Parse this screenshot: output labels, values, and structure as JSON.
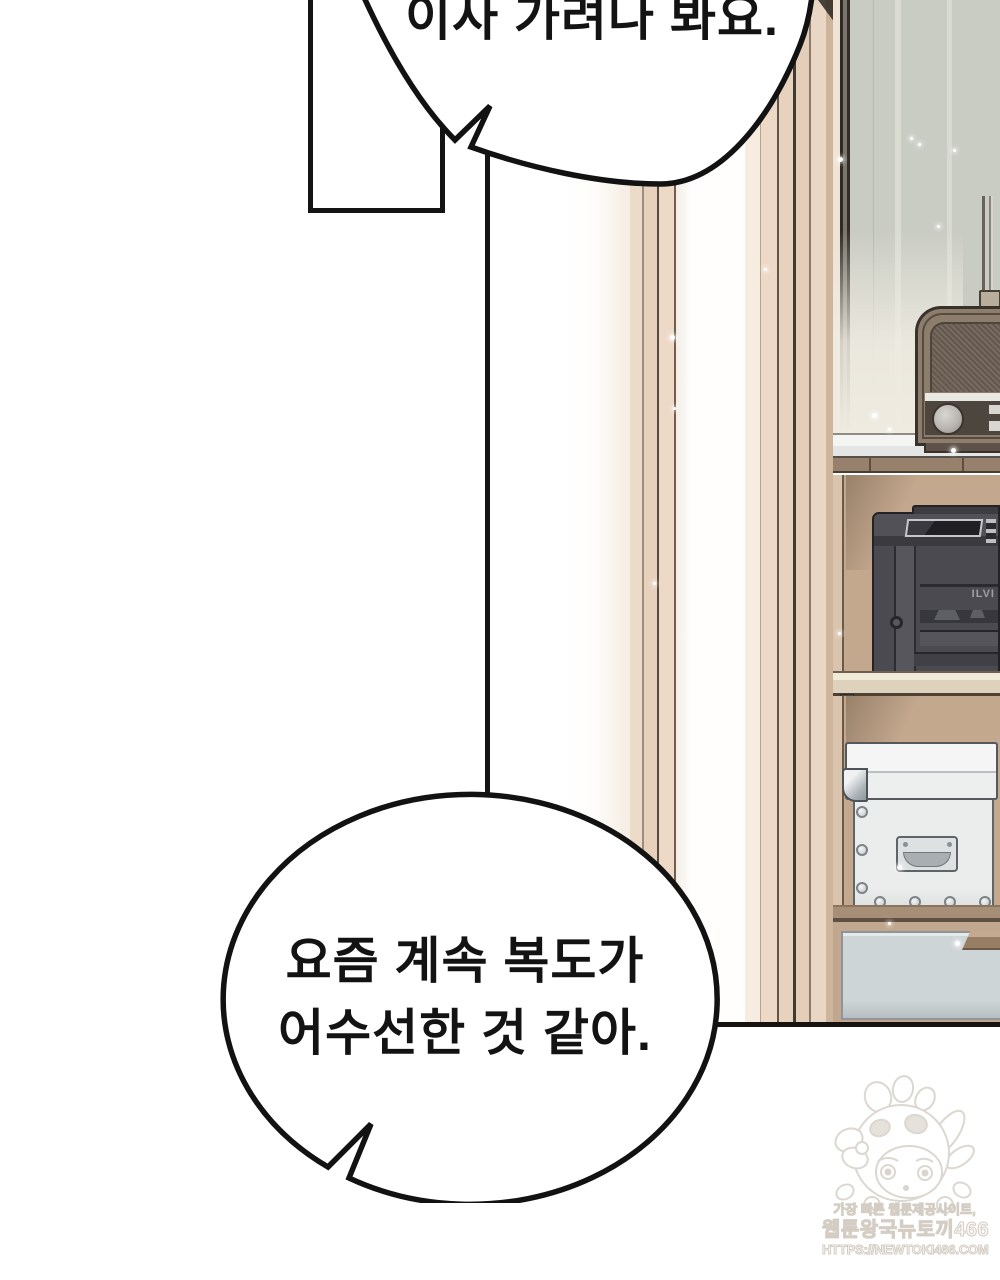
{
  "meta": {
    "kind": "webtoon-comic-page",
    "language": "ko"
  },
  "bubbles": {
    "top": {
      "text": "이사 가려나 봐요."
    },
    "bottom": {
      "line1": "요즘 계속 복도가",
      "line2": "어수선한 것 같아."
    }
  },
  "background": {
    "printer_label": "ILVI",
    "objects": [
      "wall-panels",
      "door-frame-boards",
      "radio-antenna",
      "vintage-radio",
      "white-shelf",
      "printer",
      "riveted-storage-box",
      "drawer"
    ]
  },
  "watermark": {
    "tagline": "가장 빠른 웹툰제공사이트,",
    "site_name": "웹툰왕국뉴토끼466",
    "url": "HTTPS://NEWTOKI466.COM",
    "mascot": "bunny-hood-girl"
  },
  "colors": {
    "ink": "#141414",
    "paper": "#ffffff",
    "wall_gray_green": "#c9ccc3",
    "wood_light": "#eed9c7",
    "shelf_tan": "#c3a88e",
    "printer_gray": "#4a4a50",
    "box_white": "#edefee",
    "drawer_gray": "#ced5d7",
    "radio_brown": "#8d7d6d",
    "watermark_gray": "#d4cdc4"
  }
}
